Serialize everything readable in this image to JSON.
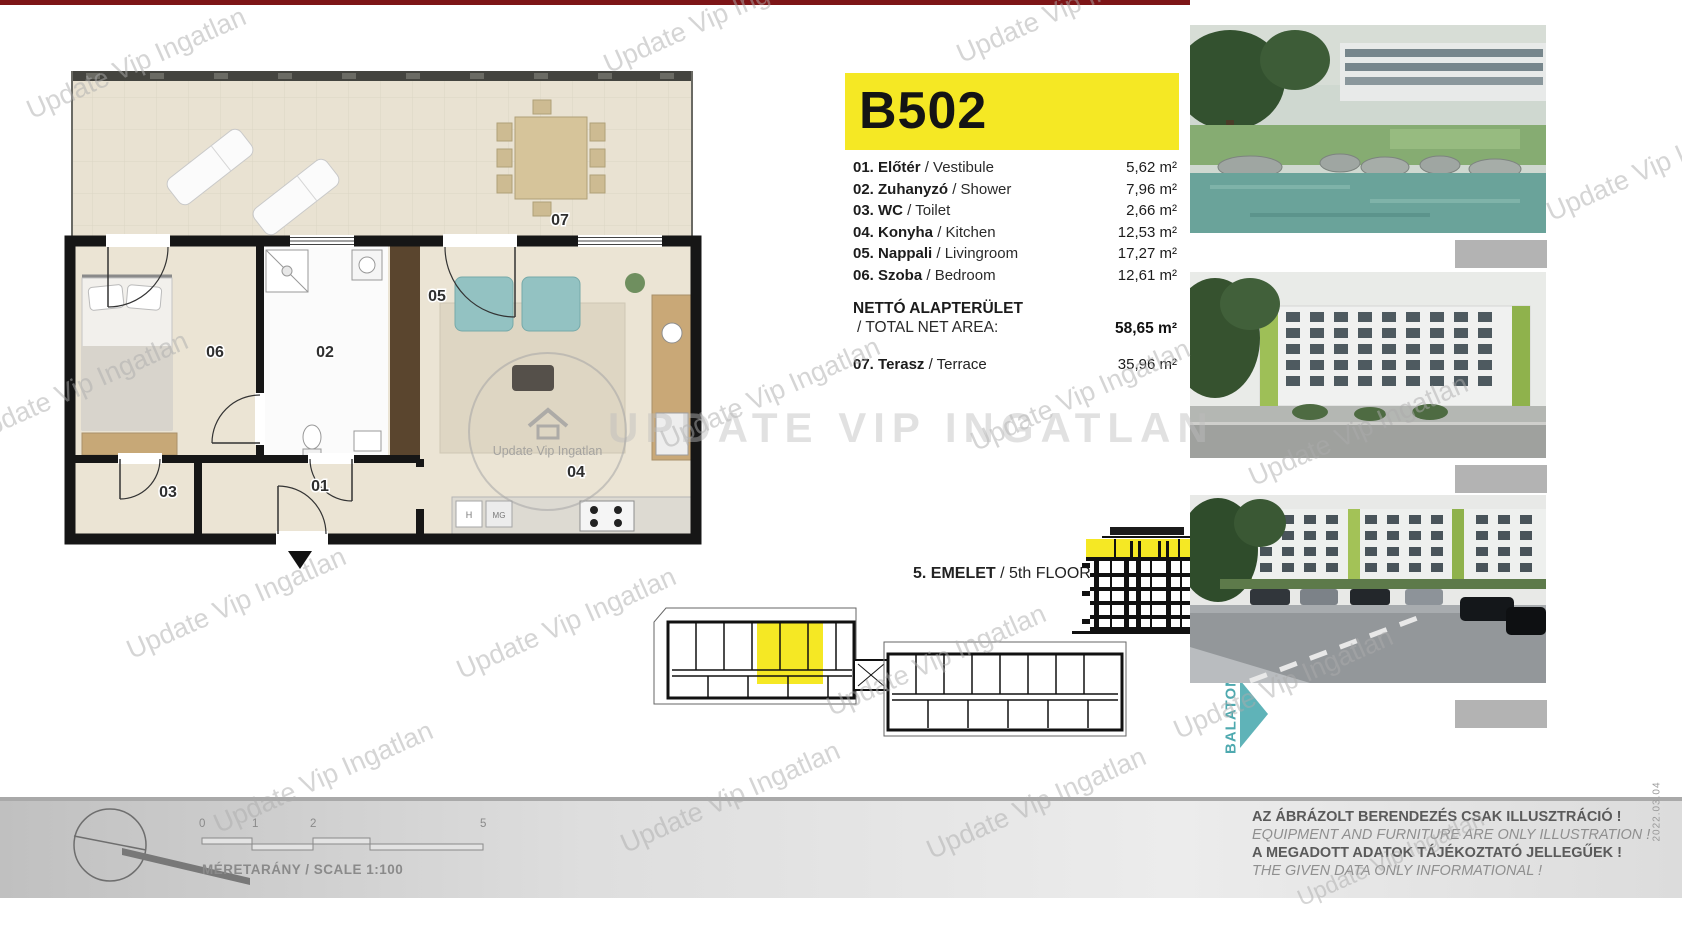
{
  "unit": {
    "id": "B502"
  },
  "rooms": [
    {
      "name_hu": "01. Előtér",
      "name_en": " / Vestibule",
      "area": "5,62 m²"
    },
    {
      "name_hu": "02. Zuhanyzó",
      "name_en": " / Shower",
      "area": "7,96 m²"
    },
    {
      "name_hu": "03. WC",
      "name_en": " / Toilet",
      "area": "2,66 m²"
    },
    {
      "name_hu": "04. Konyha",
      "name_en": " / Kitchen",
      "area": "12,53 m²"
    },
    {
      "name_hu": "05. Nappali",
      "name_en": " / Livingroom",
      "area": "17,27 m²"
    },
    {
      "name_hu": "06. Szoba",
      "name_en": " / Bedroom",
      "area": "12,61 m²"
    }
  ],
  "net_area": {
    "label_hu": "NETTÓ ALAPTERÜLET",
    "label_en": "/ TOTAL NET AREA:",
    "value": "58,65 m²"
  },
  "terrace_row": {
    "name_hu": "07. Terasz",
    "name_en": " / Terrace",
    "area": "35,96 m²"
  },
  "floor": {
    "label_hu": "5. EMELET",
    "label_en": " / 5th FLOOR"
  },
  "balaton_label": "BALATON",
  "plan_labels": {
    "r01": "01",
    "r02": "02",
    "r03": "03",
    "r04": "04",
    "r05": "05",
    "r06": "06",
    "r07": "07",
    "h": "H",
    "mg": "MG"
  },
  "scale": {
    "ticks": [
      "0",
      "1",
      "2",
      "5"
    ],
    "label": "MÉRETARÁNY / SCALE  1:100"
  },
  "disclaimer": {
    "line1": "AZ ÁBRÁZOLT BERENDEZÉS CSAK ILLUSZTRÁCIÓ !",
    "line2": "EQUIPMENT AND FURNITURE ARE ONLY ILLUSTRATION !",
    "line3": "A MEGADOTT ADATOK TÁJÉKOZTATÓ JELLEGŰEK !",
    "line4": "THE GIVEN DATA ONLY INFORMATIONAL !"
  },
  "date_stamp": "2022.03.04",
  "watermark": {
    "diagonal": "Update Vip Ingatlan",
    "center": "UPDATE VIP INGATLAN",
    "logo_text": "Update Vip Ingatlan"
  },
  "colors": {
    "highlight_yellow": "#f5e824",
    "balaton_teal": "#5fb3b8",
    "wall_black": "#161616",
    "sofa_teal": "#93c2c2",
    "floor_beige": "#ebe4d4",
    "wood": "#c7a877",
    "top_bar_red": "#7d1517"
  }
}
